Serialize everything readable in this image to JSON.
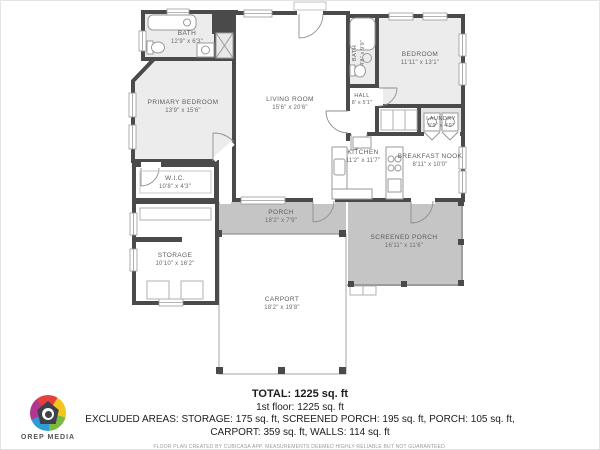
{
  "colors": {
    "wall": "#4a4a4a",
    "room_fill": "#ececec",
    "porch_fill": "#c5c5c5",
    "label_text": "#5d5d5d"
  },
  "rooms": {
    "bath_main": {
      "name": "BATH",
      "dims": "12'9\" x 6'3\""
    },
    "primary_bedroom": {
      "name": "PRIMARY BEDROOM",
      "dims": "13'9\" x 15'6\""
    },
    "living_room": {
      "name": "LIVING ROOM",
      "dims": "15'6\" x 20'6\""
    },
    "bath_2": {
      "name": "BATH",
      "dims": "4'8\" x 9'9\""
    },
    "hall": {
      "name": "HALL",
      "dims": "8' x 5'1\""
    },
    "bedroom": {
      "name": "BEDROOM",
      "dims": "11'11\" x 13'1\""
    },
    "laundry": {
      "name": "LAUNDRY",
      "dims": "5'9\" x 4'9\""
    },
    "kitchen": {
      "name": "KITCHEN",
      "dims": "11'2\" x 11'7\""
    },
    "breakfast_nook": {
      "name": "BREAKFAST NOOK",
      "dims": "8'11\" x 10'0\""
    },
    "wic": {
      "name": "W.I.C.",
      "dims": "10'8\" x 4'3\""
    },
    "storage": {
      "name": "STORAGE",
      "dims": "10'10\" x 16'2\""
    },
    "porch": {
      "name": "PORCH",
      "dims": "18'2\" x 7'9\""
    },
    "screened_porch": {
      "name": "SCREENED PORCH",
      "dims": "16'11\" x 11'6\""
    },
    "carport": {
      "name": "CARPORT",
      "dims": "18'2\" x 19'8\""
    }
  },
  "summary": {
    "total": "TOTAL: 1225 sq. ft",
    "floor_1": "1st floor: 1225 sq. ft",
    "excluded_line_1": "EXCLUDED AREAS: STORAGE: 175 sq. ft, SCREENED PORCH: 195 sq. ft, PORCH: 105 sq. ft,",
    "excluded_line_2": "CARPORT: 359 sq. ft, WALLS: 114 sq. ft",
    "disclaimer": "FLOOR PLAN CREATED BY CUBICASA APP. MEASUREMENTS DEEMED HIGHLY RELIABLE BUT NOT GUARANTEED."
  },
  "branding": {
    "name": "OREP MEDIA"
  }
}
